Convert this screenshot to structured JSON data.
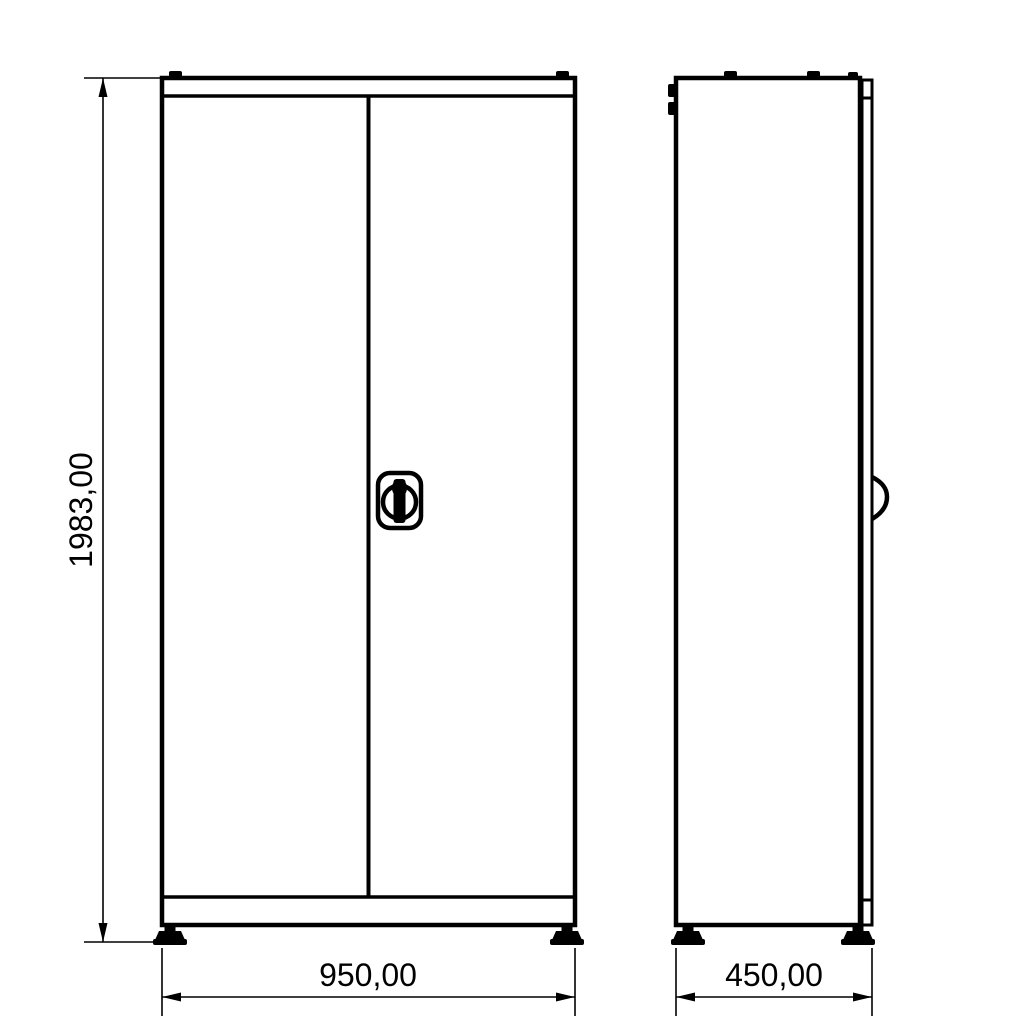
{
  "drawing": {
    "type": "technical-dimension-drawing",
    "subject": "two-door cabinet, front and side orthographic views",
    "background_color": "#ffffff",
    "line_color": "#000000"
  },
  "views": {
    "front": {
      "name": "front-view",
      "features": [
        "top-cap",
        "left-door",
        "right-door",
        "swing-lock-handle",
        "bottom-plinth",
        "two-adjustable-feet"
      ]
    },
    "side": {
      "name": "side-view",
      "features": [
        "top-cap-tabs",
        "hinge-knuckles",
        "door-edge-strip",
        "handle-profile",
        "two-adjustable-feet"
      ]
    }
  },
  "dimensions": {
    "height": "1983,00",
    "width": "950,00",
    "depth": "450,00"
  },
  "icons": {
    "lock_handle": "swing-handle-lock-icon",
    "side_handle": "handle-profile-icon"
  }
}
